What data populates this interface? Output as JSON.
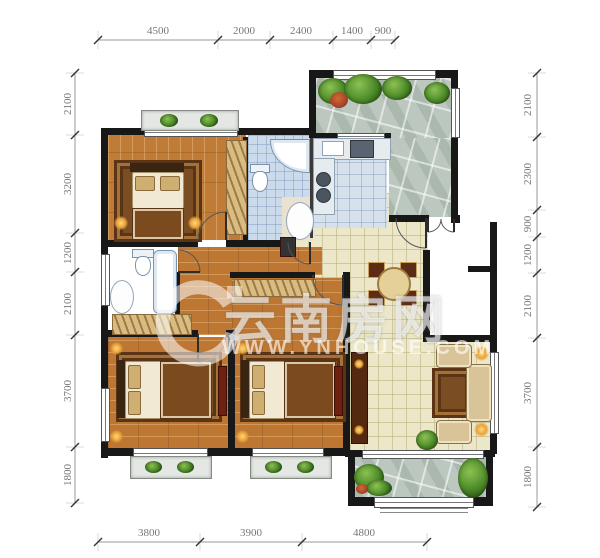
{
  "watermark": {
    "brand": "云南房网",
    "url": "WWW.YNHOUSE.COM",
    "logo": "e-swoosh-logo"
  },
  "dimensions": {
    "top": [
      "4500",
      "2000",
      "2400",
      "1400",
      "900"
    ],
    "bottom": [
      "3800",
      "3900",
      "4800"
    ],
    "left": [
      "2100",
      "3200",
      "1200",
      "2100",
      "3700",
      "1800"
    ],
    "right": [
      "2100",
      "2300",
      "900",
      "1200",
      "2100",
      "3700",
      "1800"
    ]
  },
  "palette": {
    "wall": "#181818",
    "wood_floor": "#c07b36",
    "tile_floor": "#ece7c9",
    "bath_tile": "#ccdbeb",
    "stone_terrace": "#bcc8bf",
    "plant_green": "#4c8a28",
    "dim_text": "#777777",
    "watermark_white": "rgba(255,255,255,0.62)"
  }
}
